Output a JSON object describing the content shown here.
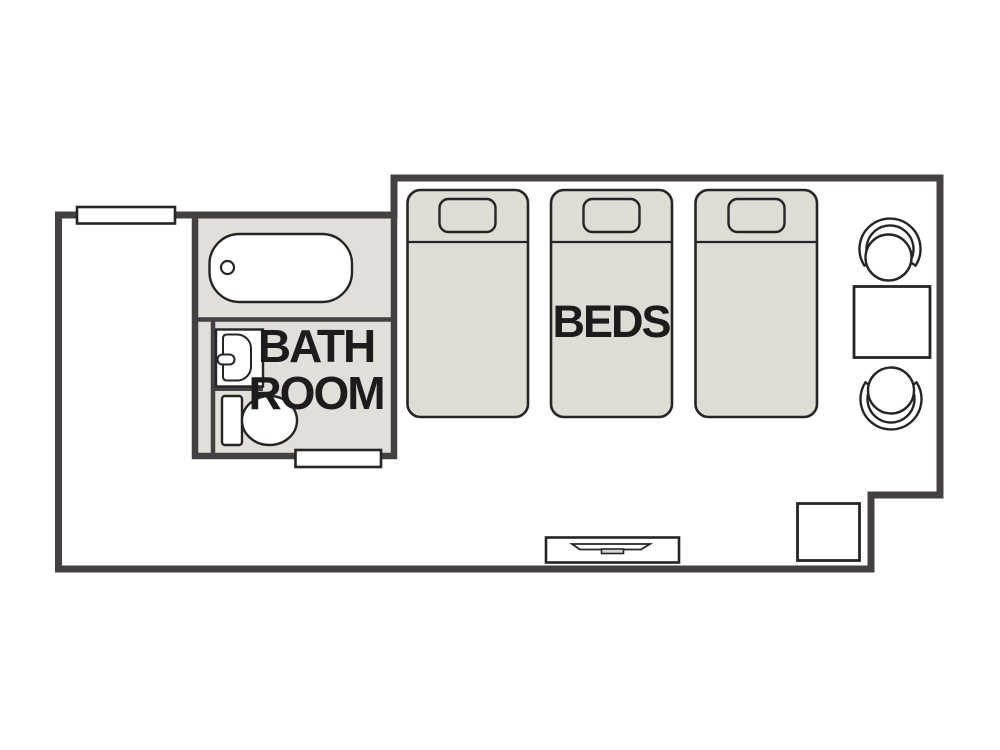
{
  "title": "Hotel room floor plan",
  "labels": {
    "beds": "BEDS",
    "bathroom_line1": "BATH",
    "bathroom_line2": "ROOM"
  },
  "rooms": [
    {
      "name": "bathroom",
      "label": "BATH ROOM"
    },
    {
      "name": "bedroom",
      "label": "BEDS"
    }
  ],
  "furniture": {
    "beds_count": 3,
    "chairs_count": 2,
    "items": [
      "window",
      "bathtub",
      "sink",
      "toilet",
      "door",
      "bed",
      "bed",
      "bed",
      "chair",
      "table",
      "chair",
      "tv-console",
      "cabinet"
    ]
  },
  "colors": {
    "wall": "#454142",
    "outline": "#262425",
    "bathroom_fill": "#e2dfda",
    "bed_fill": "#dfdcd6",
    "fixture_fill": "#ffffff",
    "tv_stand_fill": "#d8d5d0",
    "text": "#1d1b1c",
    "background": "#ffffff"
  }
}
